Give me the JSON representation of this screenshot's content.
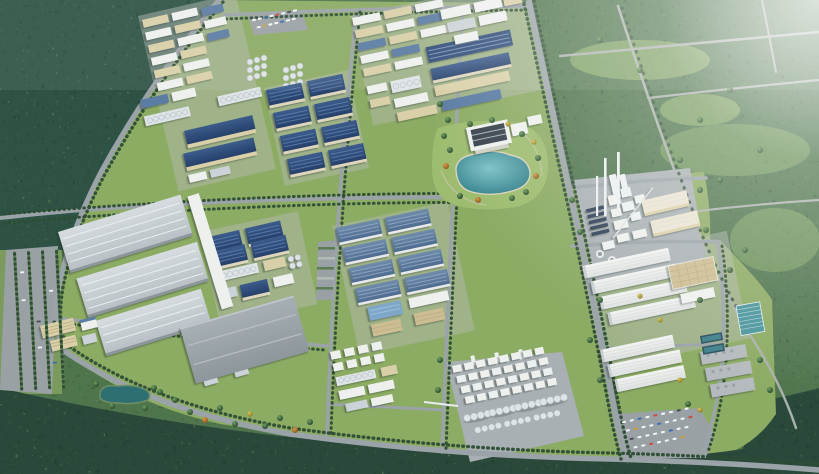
{
  "scene": {
    "alt": "Aerial bird's-eye 3D rendering of a large industrial park master plan: grids of blue-roofed and white warehouses, a chemical plant with silo rows, a cement plant with tall chimneys, a landscaped lake, tree-lined boulevards and parking lots, surrounded by dense forest and green fields",
    "regions": [
      {
        "name": "northwest-forest",
        "label": "dense dark forest"
      },
      {
        "name": "east-scrubland",
        "label": "green scrub and forest crossed by rural roads"
      },
      {
        "name": "south-forest-belt",
        "label": "forest belt along bottom edge"
      },
      {
        "name": "upper-left-light-industry",
        "label": "rows of small tan and white factory buildings"
      },
      {
        "name": "navy-warehouse-grid",
        "label": "grid of eight navy-roofed warehouses"
      },
      {
        "name": "process-plant-with-silo-banks",
        "label": "process buildings with white silo banks"
      },
      {
        "name": "upper-middle-district",
        "label": "mixed factory rows with solar roof"
      },
      {
        "name": "landscaped-lake",
        "label": "teal lake with park and headquarters building"
      },
      {
        "name": "cement-plant",
        "label": "cement plant with tall chimneys and cooling towers"
      },
      {
        "name": "east-white-warehouses",
        "label": "rows of long white warehouses"
      },
      {
        "name": "steel-blue-warehouse-grid",
        "label": "grid of steel-blue roofed warehouses"
      },
      {
        "name": "chemical-plant",
        "label": "chemical plant with rows of white storage silos"
      },
      {
        "name": "southwest-mega-warehouses",
        "label": "very large light gray logistics warehouses"
      },
      {
        "name": "gray-flat-warehouse",
        "label": "large flat gray warehouse in meadow"
      },
      {
        "name": "water-treatment",
        "label": "water treatment pools and panel field"
      },
      {
        "name": "parking-lots",
        "label": "striped parking lots with cars"
      }
    ]
  },
  "palette": {
    "base_forest": "#4f744e",
    "forest_dark": "#2f5244",
    "forest_strip": "#3a5c46",
    "forest_bottom": "#2a493b",
    "lawn": "#8cab63",
    "lawn_light": "#9dbc6f",
    "glade": "#86aa68",
    "pad": "#a9b0b3",
    "pad_light": "#b7bdb8",
    "road": "#9aa3a7",
    "road_field": "#a9b0a9",
    "treeline": "#2d4c35",
    "roof_navy": "#2c4a74",
    "roof_steel": "#5b7ca3",
    "roof_solar": "#2e4a78",
    "roof_white": "#eef0ee",
    "roof_tan": "#d9cfa8",
    "roof_gray": "#99a1a7",
    "roof_gray_light": "#ccd3d8",
    "wall_cream": "#ddd6bd",
    "silo_white": "#dde3e6",
    "chimney": "#eceff0",
    "glass_dark": "#37424c",
    "tan_grid": "#cdbd92",
    "lake_center": "#7cc2c6",
    "lake_edge": "#2e7b86",
    "pond": "#2e6f74",
    "pool_dark": "#29505c",
    "panel_teal": "#48949b",
    "parking": "#9aa1a5",
    "car_white": "#f2f4f5",
    "car_red": "#c94f44",
    "car_blue": "#3f6fae",
    "car_dark": "#474c4f",
    "car_yellow": "#c9a33a",
    "haze": "#ffffff"
  }
}
